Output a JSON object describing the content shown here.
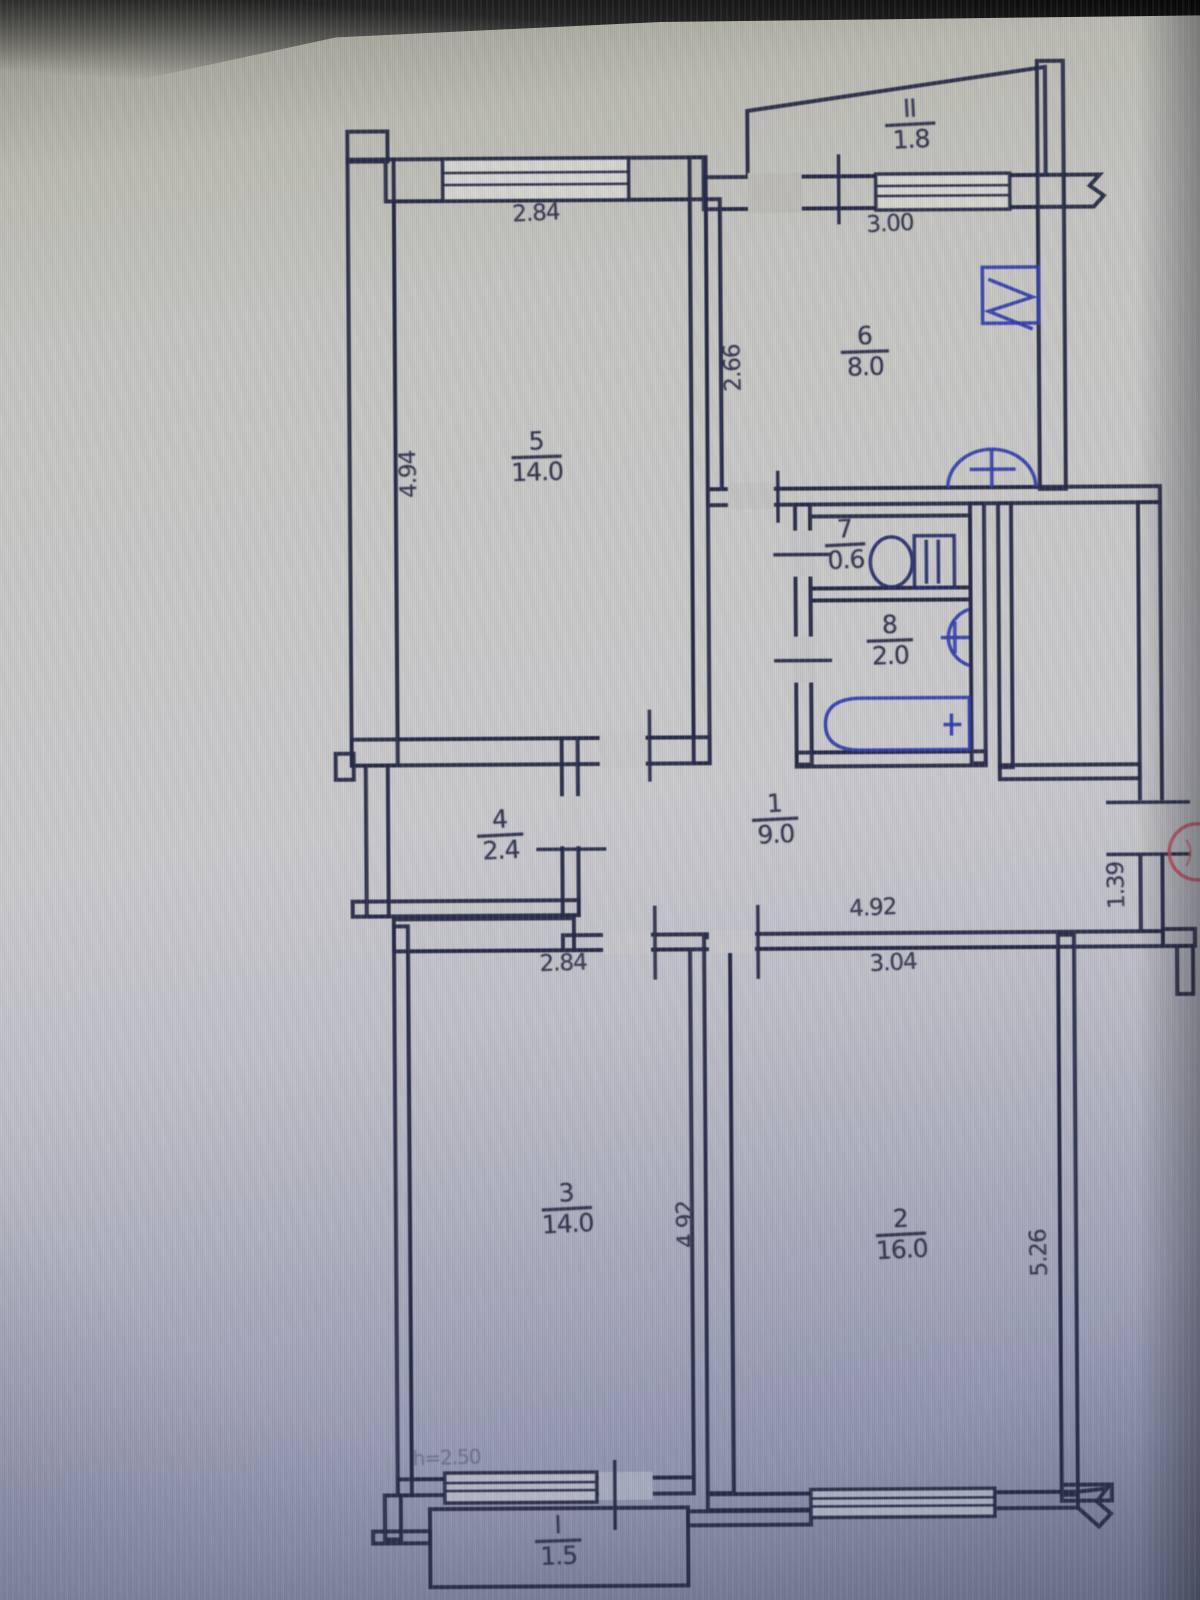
{
  "rooms": [
    {
      "number": "1",
      "area": "9.0"
    },
    {
      "number": "2",
      "area": "16.0"
    },
    {
      "number": "3",
      "area": "14.0"
    },
    {
      "number": "4",
      "area": "2.4"
    },
    {
      "number": "5",
      "area": "14.0"
    },
    {
      "number": "6",
      "area": "8.0"
    },
    {
      "number": "7",
      "area": "0.6"
    },
    {
      "number": "8",
      "area": "2.0"
    }
  ],
  "balconies": [
    {
      "number": "II",
      "area": "1.8"
    },
    {
      "number": "I",
      "area": "1.5"
    }
  ],
  "dimensions": {
    "room5_width": "2.84",
    "room5_depth": "4.94",
    "room6_width": "3.00",
    "room6_depth": "2.66",
    "hall_width": "4.92",
    "entry_width": "1.39",
    "room3_width": "2.84",
    "room3_depth": "4.92",
    "room2_width": "3.04",
    "room2_depth": "5.26",
    "ceiling_height": "h=2.50"
  },
  "colors": {
    "ink": "#262944",
    "fixture": "#2e3cae",
    "stamp": "#cf4f62"
  }
}
